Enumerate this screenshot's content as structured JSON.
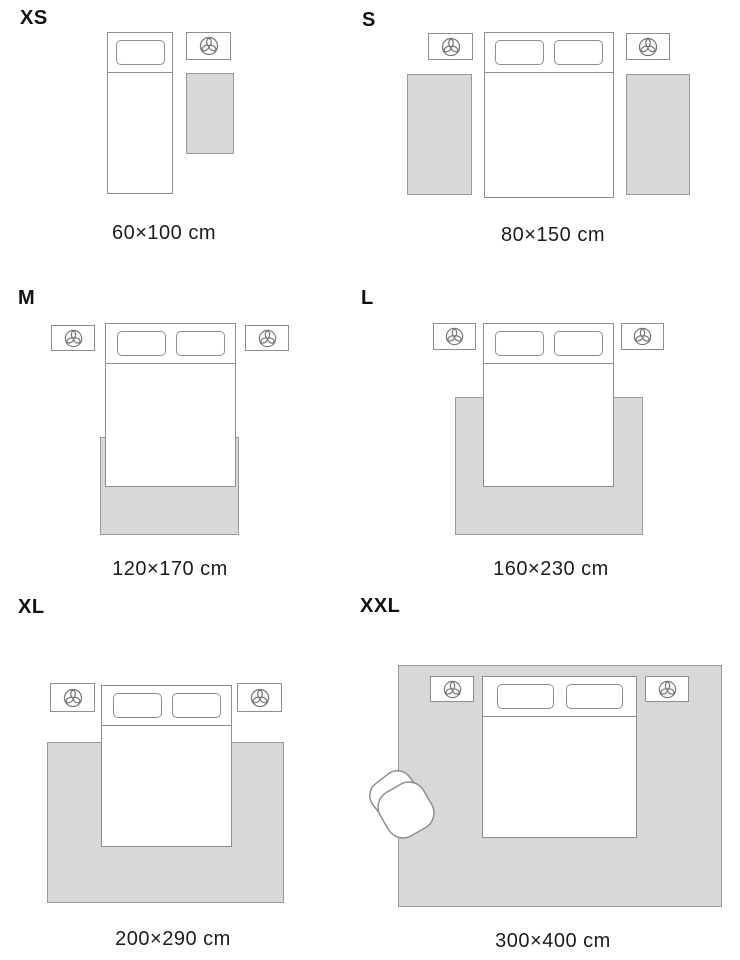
{
  "title": "Rug size guide",
  "sizes": [
    {
      "label": "XS",
      "dimensions": "60×100 cm"
    },
    {
      "label": "S",
      "dimensions": "80×150 cm"
    },
    {
      "label": "M",
      "dimensions": "120×170 cm"
    },
    {
      "label": "L",
      "dimensions": "160×230 cm"
    },
    {
      "label": "XL",
      "dimensions": "200×290 cm"
    },
    {
      "label": "XXL",
      "dimensions": "300×400 cm"
    }
  ],
  "icons": {
    "nightstand": "plant-top-view-icon",
    "armchair": "armchair-top-view"
  },
  "colors": {
    "background": "#ffffff",
    "outline": "#8e8e8e",
    "rug_fill": "#d8d8d8",
    "rug_border": "#999999",
    "text": "#1c1c1c"
  }
}
